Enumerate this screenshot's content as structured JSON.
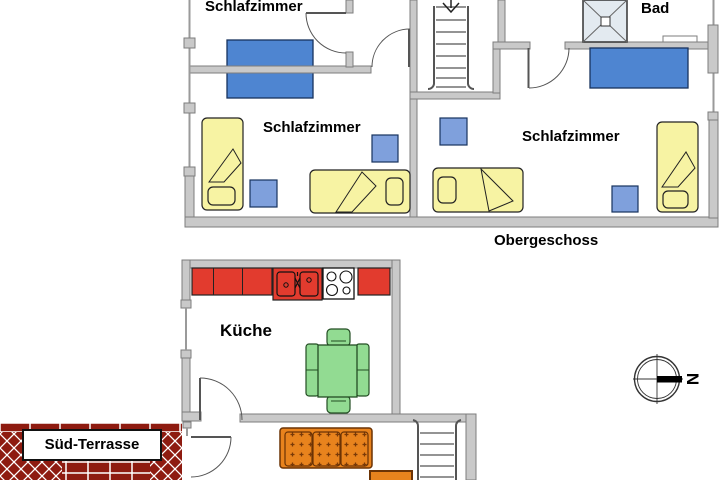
{
  "floor_plan": {
    "labels": {
      "bedroom_top": "Schlafzimmer",
      "bedroom_left": "Schlafzimmer",
      "bedroom_right": "Schlafzimmer",
      "bathroom": "Bad",
      "upper_floor_caption": "Obergeschoss",
      "kitchen": "Küche",
      "terrace": "Süd-Terrasse",
      "compass_north": "N"
    },
    "colors": {
      "wall_fill": "#C9C9C9",
      "wall_edge": "#7D7D7D",
      "bed_yellow": "#F7F3A3",
      "furniture_blue": "#4E85D1",
      "nightstand_blue": "#7FA0DC",
      "kitchen_counter_red": "#E23B2E",
      "dining_green": "#92DB92",
      "sofa_orange": "#E8831D",
      "terrace_brick": "#8E1B10",
      "outline_black": "#1A1A1A"
    },
    "fixtures": [
      "bed",
      "wardrobe",
      "nightstand",
      "shower",
      "kitchen-sink",
      "stove",
      "dining-table",
      "chair",
      "sofa",
      "coffee-table",
      "stairs",
      "window",
      "door"
    ]
  }
}
